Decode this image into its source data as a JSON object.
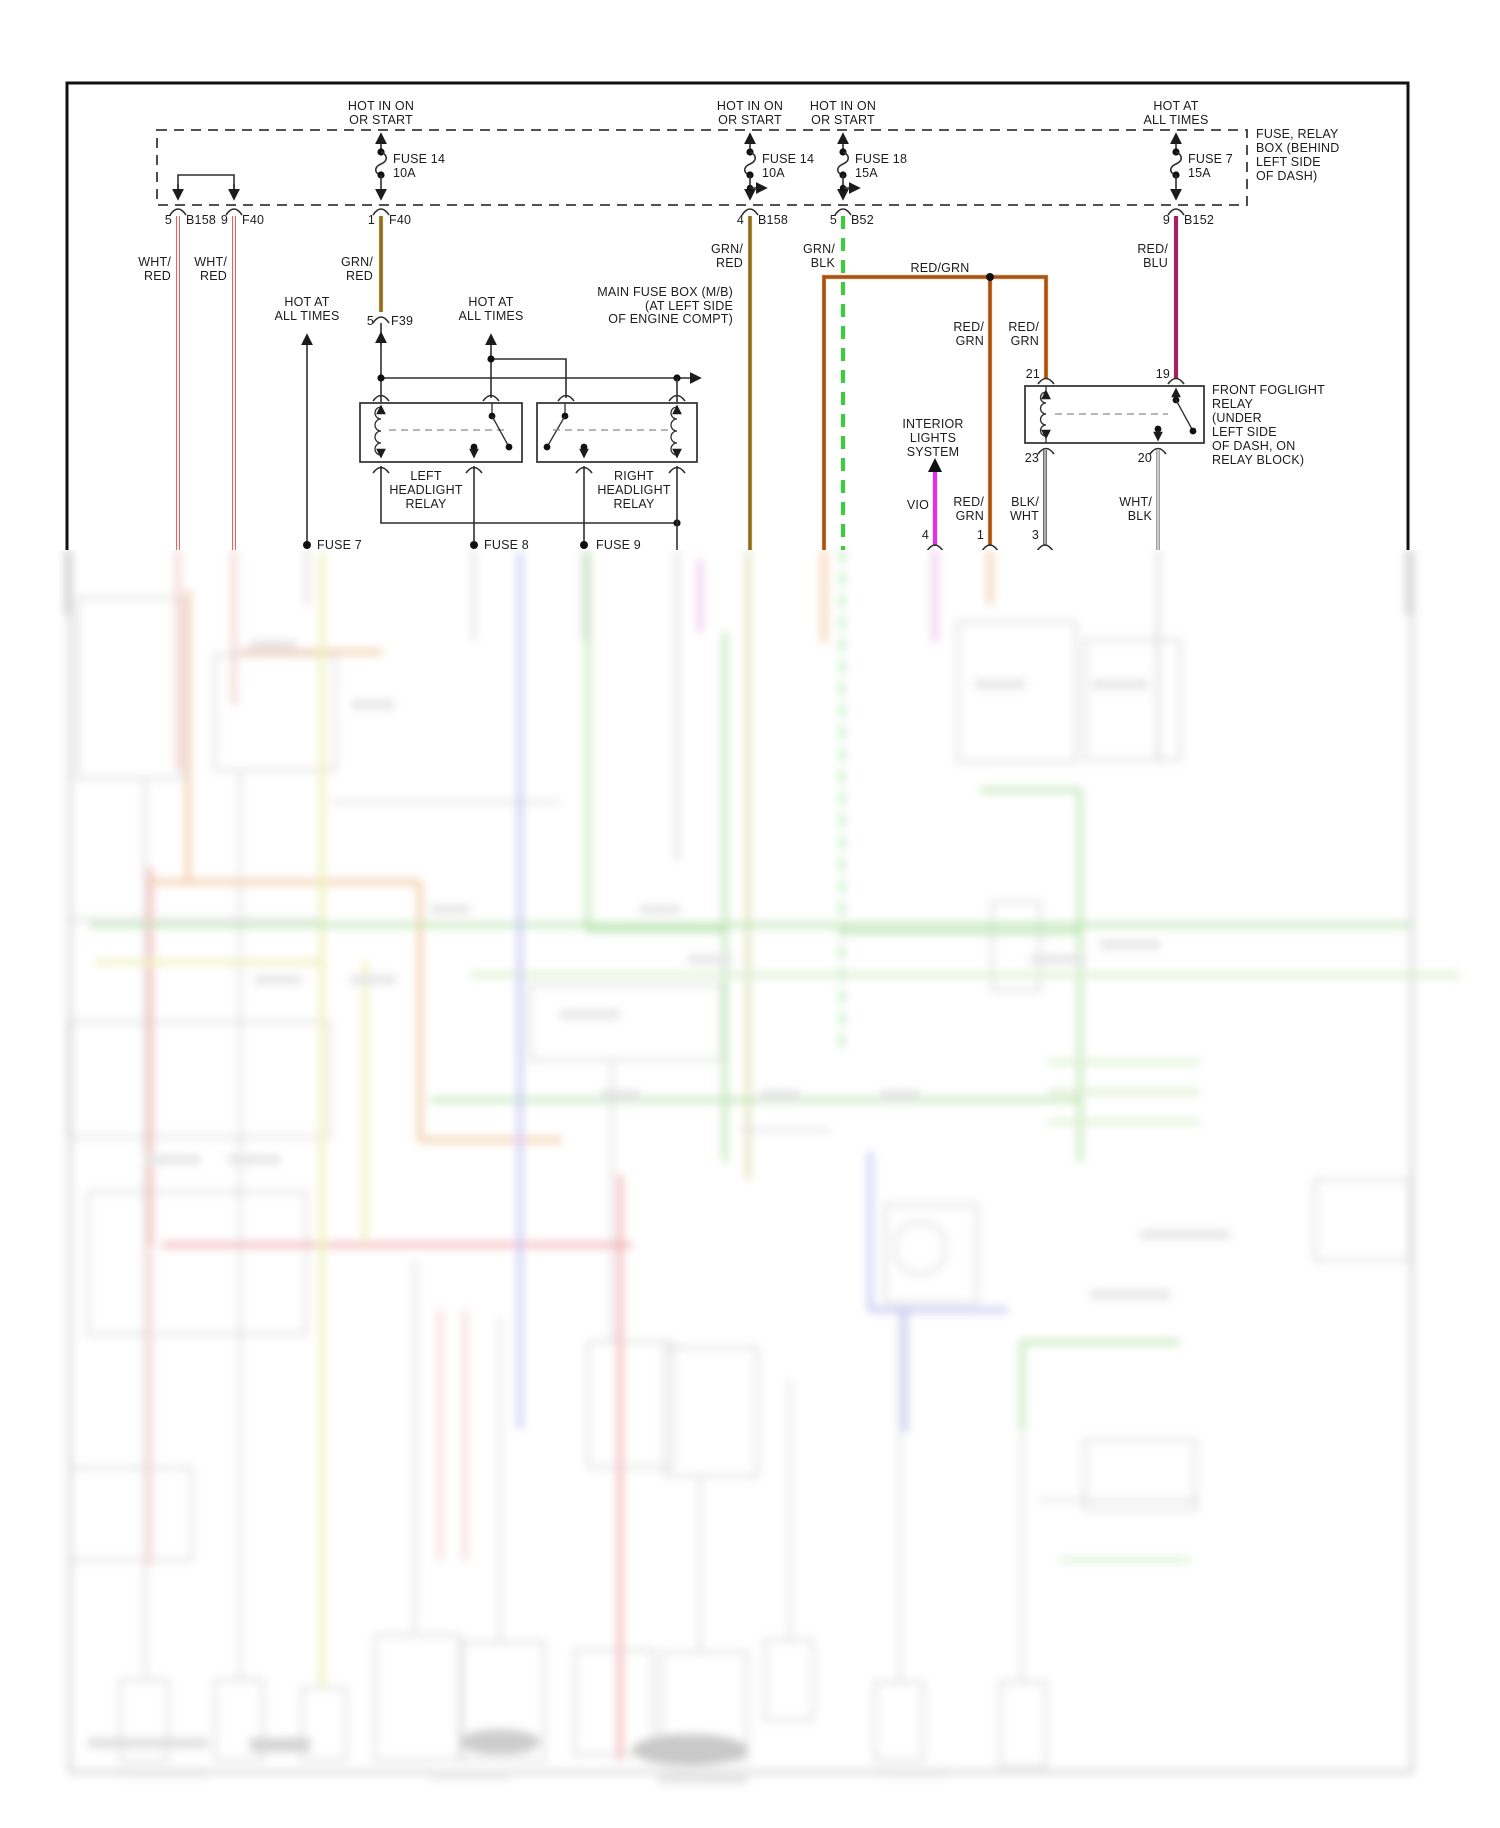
{
  "colors": {
    "wht_red": "#d96a6a",
    "grn_red_green": "#93992e",
    "grn_red_stripe": "#a5392a",
    "grn_blk": "#3fcb3f",
    "red_grn": "#c96f24",
    "red_grn_stripe": "#7d3a14",
    "red_blu": "#a12364",
    "vio": "#e52ee5",
    "blk_wht": "#4a4a4a",
    "wht_blk": "#8b8b8b",
    "line": "#2e2e2e"
  },
  "headers": {
    "h1": {
      "l1": "HOT IN ON",
      "l2": "OR START"
    },
    "h2": {
      "l1": "HOT IN ON",
      "l2": "OR START"
    },
    "h3": {
      "l1": "HOT IN ON",
      "l2": "OR START"
    },
    "h4": {
      "l1": "HOT AT",
      "l2": "ALL TIMES"
    },
    "h5": {
      "l1": "HOT AT",
      "l2": "ALL TIMES"
    },
    "h6": {
      "l1": "HOT AT",
      "l2": "ALL TIMES"
    }
  },
  "fuses": {
    "f14a": {
      "name": "FUSE 14",
      "rating": "10A"
    },
    "f14b": {
      "name": "FUSE 14",
      "rating": "10A"
    },
    "f18": {
      "name": "FUSE 18",
      "rating": "15A"
    },
    "f7": {
      "name": "FUSE 7",
      "rating": "15A"
    }
  },
  "fuse_box_note": {
    "l1": "FUSE, RELAY",
    "l2": "BOX (BEHIND",
    "l3": "LEFT SIDE",
    "l4": "OF DASH)"
  },
  "main_fuse_box_note": {
    "l1": "MAIN FUSE BOX (M/B)",
    "l2": "(AT LEFT SIDE",
    "l3": "OF ENGINE COMPT)"
  },
  "connectors": {
    "c1": {
      "pin": "5",
      "name": "B158"
    },
    "c2": {
      "pin": "9",
      "name": "F40"
    },
    "c3": {
      "pin": "1",
      "name": "F40"
    },
    "c4": {
      "pin": "4",
      "name": "B158"
    },
    "c5": {
      "pin": "5",
      "name": "B52"
    },
    "c6": {
      "pin": "9",
      "name": "B152"
    },
    "c7": {
      "pin": "5",
      "name": "F39"
    }
  },
  "wire_labels": {
    "w1": {
      "l1": "WHT/",
      "l2": "RED"
    },
    "w2": {
      "l1": "WHT/",
      "l2": "RED"
    },
    "w3": {
      "l1": "GRN/",
      "l2": "RED"
    },
    "w4": {
      "l1": "GRN/",
      "l2": "RED"
    },
    "w5": {
      "l1": "GRN/",
      "l2": "BLK"
    },
    "w6": {
      "l1": "RED/",
      "l2": "BLU"
    },
    "w7": "RED/GRN",
    "w8": {
      "l1": "RED/",
      "l2": "GRN"
    },
    "w9": {
      "l1": "RED/",
      "l2": "GRN"
    },
    "w10": "VIO",
    "w11": {
      "l1": "RED/",
      "l2": "GRN"
    },
    "w12": {
      "l1": "BLK/",
      "l2": "WHT"
    },
    "w13": {
      "l1": "WHT/",
      "l2": "BLK"
    }
  },
  "relays": {
    "left_headlight": {
      "l1": "LEFT",
      "l2": "HEADLIGHT",
      "l3": "RELAY"
    },
    "right_headlight": {
      "l1": "RIGHT",
      "l2": "HEADLIGHT",
      "l3": "RELAY"
    },
    "front_foglight": {
      "l1": "FRONT FOGLIGHT",
      "l2": "RELAY",
      "l3": "(UNDER",
      "l4": "LEFT SIDE",
      "l5": "OF DASH, ON",
      "l6": "RELAY BLOCK)"
    },
    "pins": {
      "p21": "21",
      "p19": "19",
      "p23": "23",
      "p20": "20"
    }
  },
  "interior_lights": {
    "l1": "INTERIOR",
    "l2": "LIGHTS",
    "l3": "SYSTEM"
  },
  "bottom": {
    "fuse7": "FUSE 7",
    "fuse8": "FUSE 8",
    "fuse9": "FUSE 9",
    "pin4": "4",
    "pin1": "1",
    "pin3": "3"
  }
}
